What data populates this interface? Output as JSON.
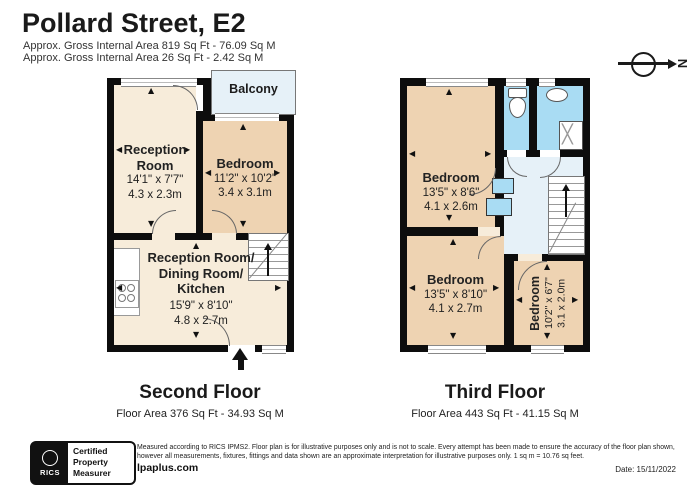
{
  "header": {
    "title": "Pollard Street, E2",
    "area_line1": "Approx. Gross Internal Area 819 Sq Ft - 76.09 Sq M",
    "area_line2": "Approx. Gross Internal Area 26 Sq Ft - 2.42 Sq M"
  },
  "compass": {
    "north_label": "N"
  },
  "floors": [
    {
      "name": "Second Floor",
      "area_label": "Floor Area 376 Sq Ft - 34.93 Sq M",
      "balcony_label": "Balcony",
      "rooms": [
        {
          "name": "Reception Room",
          "dims_ft": "14'1\" x 7'7\"",
          "dims_m": "4.3 x 2.3m"
        },
        {
          "name": "Bedroom",
          "dims_ft": "11'2\" x 10'2\"",
          "dims_m": "3.4 x 3.1m"
        },
        {
          "name_lines": [
            "Reception Room/",
            "Dining Room/",
            "Kitchen"
          ],
          "dims_ft": "15'9\" x 8'10\"",
          "dims_m": "4.8 x 2.7m"
        }
      ]
    },
    {
      "name": "Third Floor",
      "area_label": "Floor Area 443 Sq Ft - 41.15 Sq M",
      "rooms": [
        {
          "name": "Bedroom",
          "dims_ft": "13'5\" x 8'6\"",
          "dims_m": "4.1 x 2.6m"
        },
        {
          "name": "Bedroom",
          "dims_ft": "13'5\" x 8'10\"",
          "dims_m": "4.1 x 2.7m"
        },
        {
          "name": "Bedroom",
          "dims_ft": "10'2\" x 6'7\"",
          "dims_m": "3.1 x 2.0m"
        }
      ]
    }
  ],
  "footer": {
    "rics_label": "RICS",
    "badge_lines": [
      "Certified",
      "Property",
      "Measurer"
    ],
    "disclaimer_line1": "Measured according to RICS IPMS2. Floor plan is for illustrative purposes only and is not to scale. Every attempt has been made to ensure the accuracy of the floor plan shown,",
    "disclaimer_line2": "however all measurements, fixtures, fittings and data shown are an approximate interpretation for illustrative purposes only. 1 sq m = 10.76 sq feet.",
    "website": "lpaplus.com",
    "date_label": "Date: 15/11/2022"
  },
  "colors": {
    "wall": "#0d0d0d",
    "room-cream": "#f7ecda",
    "room-tan": "#eed3b2",
    "bath-blue": "#a9dcf3",
    "pale-blue": "#e6f1f8"
  }
}
